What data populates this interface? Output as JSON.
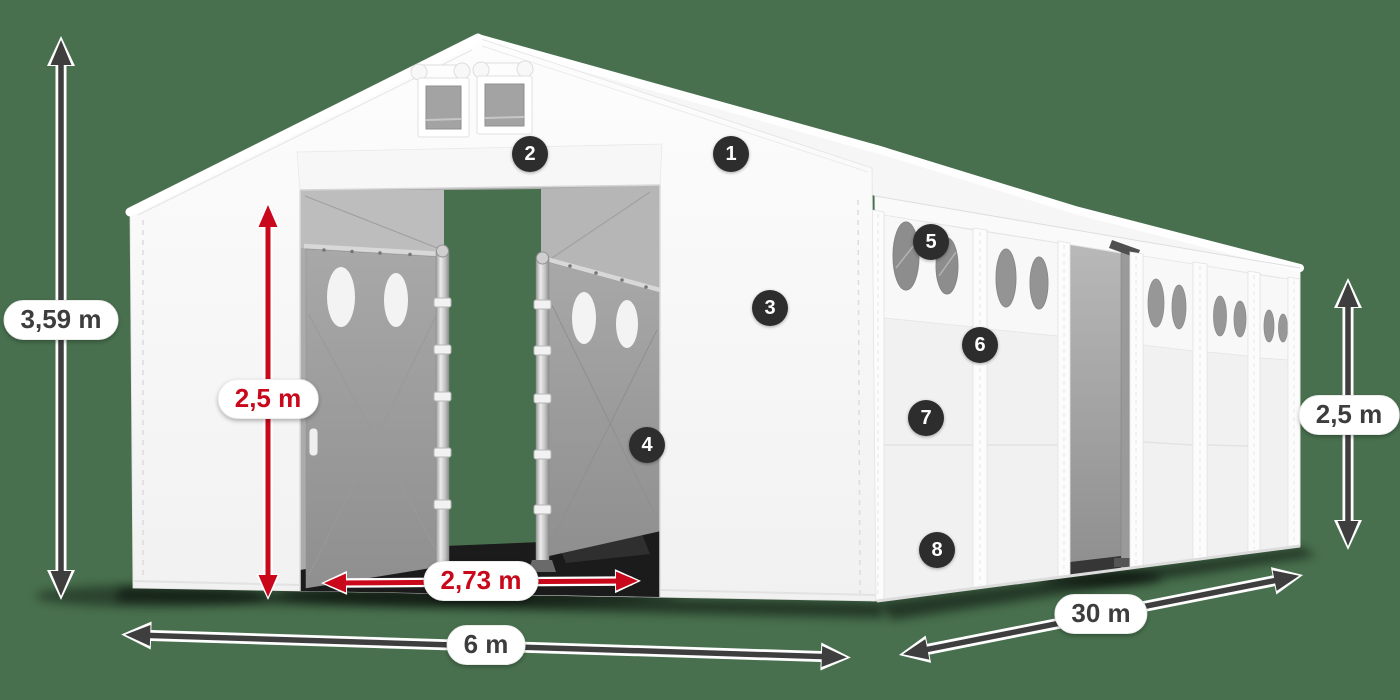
{
  "page": {
    "background_color": "#48704e"
  },
  "diagram": {
    "subject": "white-storage-tent",
    "tent_color": "#f6f6f6",
    "interior_color": "#ababab"
  },
  "colors": {
    "background_green": "#48704e",
    "dimension_dark": "#3e3e3e",
    "dimension_red": "#c9091b",
    "marker_background": "#2d2d2d",
    "marker_text": "#ffffff"
  },
  "dimensions": {
    "total_height": {
      "label": "3,59 m",
      "style": "dark"
    },
    "entrance_height": {
      "label": "2,5 m",
      "style": "red"
    },
    "entrance_width": {
      "label": "2,73 m",
      "style": "red"
    },
    "width": {
      "label": "6 m",
      "style": "dark"
    },
    "length": {
      "label": "30 m",
      "style": "dark"
    },
    "side_height": {
      "label": "2,5 m",
      "style": "dark"
    }
  },
  "markers": [
    "1",
    "2",
    "3",
    "4",
    "5",
    "6",
    "7",
    "8"
  ]
}
